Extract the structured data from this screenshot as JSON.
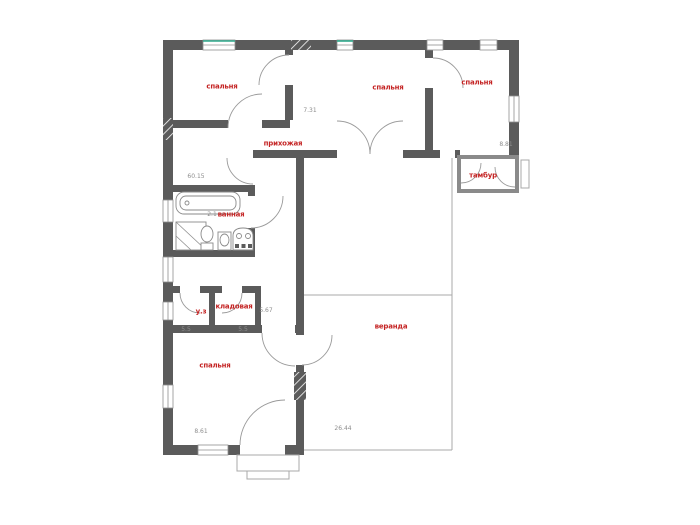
{
  "plan_title": "floor-plan",
  "colors": {
    "wall": "#5b5b5b",
    "label_red": "#c42323",
    "dim_gray": "#8d8d8d",
    "window_green": "#2fa98c",
    "thin_line": "#a8a8a8"
  },
  "room_labels": [
    {
      "id": "bedroom-1",
      "text": "спальня",
      "x": 222,
      "y": 87
    },
    {
      "id": "bedroom-2",
      "text": "спальня",
      "x": 388,
      "y": 88
    },
    {
      "id": "bedroom-3",
      "text": "спальня",
      "x": 477,
      "y": 83
    },
    {
      "id": "hallway",
      "text": "прихожая",
      "x": 283,
      "y": 144
    },
    {
      "id": "bathroom",
      "text": "ванная",
      "x": 231,
      "y": 215
    },
    {
      "id": "vestibule",
      "text": "тамбур",
      "x": 483,
      "y": 176
    },
    {
      "id": "wc",
      "text": "у.з",
      "x": 201,
      "y": 312
    },
    {
      "id": "pantry",
      "text": "кладовая",
      "x": 234,
      "y": 307
    },
    {
      "id": "bedroom-4",
      "text": "спальня",
      "x": 215,
      "y": 366
    },
    {
      "id": "veranda",
      "text": "веранда",
      "x": 391,
      "y": 327
    }
  ],
  "dim_labels": [
    {
      "id": "dim-hall",
      "text": "60.15",
      "x": 196,
      "y": 177
    },
    {
      "id": "dim-bed2",
      "text": "7.31",
      "x": 310,
      "y": 111
    },
    {
      "id": "dim-bed3",
      "text": "8.81",
      "x": 506,
      "y": 145
    },
    {
      "id": "dim-bath",
      "text": "2.1",
      "x": 212,
      "y": 215
    },
    {
      "id": "dim-pantry",
      "text": "5.67",
      "x": 266,
      "y": 311
    },
    {
      "id": "dim-wc",
      "text": "5.5",
      "x": 186,
      "y": 330
    },
    {
      "id": "dim-pantry2",
      "text": "5.5",
      "x": 243,
      "y": 330
    },
    {
      "id": "dim-bed4",
      "text": "8.61",
      "x": 201,
      "y": 432
    },
    {
      "id": "dim-veranda",
      "text": "26.44",
      "x": 343,
      "y": 429
    }
  ]
}
